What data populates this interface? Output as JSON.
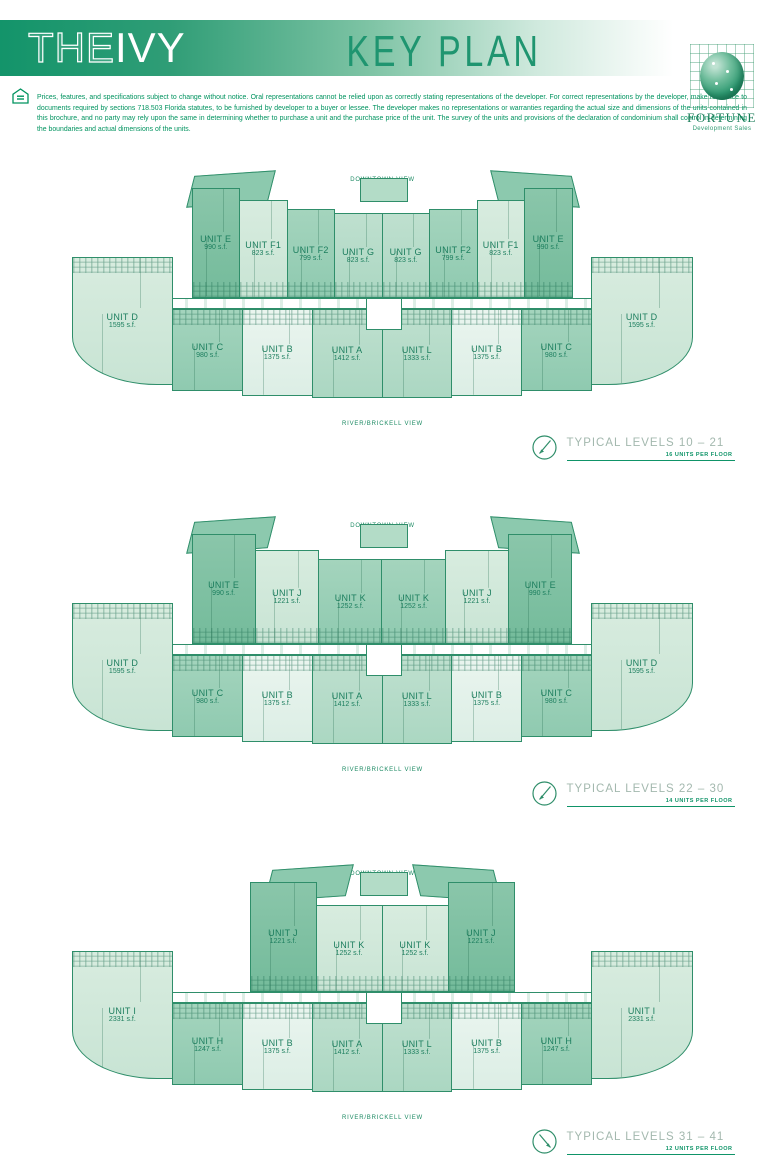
{
  "header": {
    "brand_the": "THE",
    "brand_ivy": "IVY",
    "title": "KEY PLAN",
    "logo_name": "FORTUNE",
    "logo_subtitle": "Development Sales"
  },
  "disclaimer": "Prices, features, and specifications subject to change without notice. Oral representations cannot be relied upon as correctly stating representations of the developer. For correct representations by the developer, make reference to documents required by sections 718.503 Florida statutes, to be furnished by developer to a buyer or lessee. The developer makes no representations or warranties regarding the actual size and dimensions of the units contained in this brochure, and no party may rely upon the same in determining whether to purchase a unit and the purchase price of the unit. The survey of the units and provisions of the declaration of condominium shall control in determining the boundaries and actual dimensions of the units.",
  "plans": [
    {
      "top_view_label": "DOWNTOWN VIEW",
      "bottom_view_label": "RIVER/BRICKELL VIEW",
      "caption": "TYPICAL LEVELS 10 – 21",
      "units_per_floor": "16 UNITS PER FLOOR",
      "top_units": [
        {
          "name": "UNIT E",
          "area": "990 s.f."
        },
        {
          "name": "UNIT F1",
          "area": "823 s.f."
        },
        {
          "name": "UNIT F2",
          "area": "799 s.f."
        },
        {
          "name": "UNIT G",
          "area": "823 s.f."
        },
        {
          "name": "UNIT G",
          "area": "823 s.f."
        },
        {
          "name": "UNIT F2",
          "area": "799 s.f."
        },
        {
          "name": "UNIT F1",
          "area": "823 s.f."
        },
        {
          "name": "UNIT E",
          "area": "990 s.f."
        }
      ],
      "bottom_units": [
        {
          "name": "UNIT D",
          "area": "1595 s.f."
        },
        {
          "name": "UNIT C",
          "area": "980 s.f."
        },
        {
          "name": "UNIT B",
          "area": "1375 s.f."
        },
        {
          "name": "UNIT A",
          "area": "1412 s.f."
        },
        {
          "name": "UNIT L",
          "area": "1333 s.f."
        },
        {
          "name": "UNIT B",
          "area": "1375 s.f."
        },
        {
          "name": "UNIT C",
          "area": "980 s.f."
        },
        {
          "name": "UNIT D",
          "area": "1595 s.f."
        }
      ]
    },
    {
      "top_view_label": "DOWNTOWN VIEW",
      "bottom_view_label": "RIVER/BRICKELL VIEW",
      "caption": "TYPICAL LEVELS 22 – 30",
      "units_per_floor": "14 UNITS PER FLOOR",
      "top_units": [
        {
          "name": "UNIT E",
          "area": "990 s.f."
        },
        {
          "name": "UNIT J",
          "area": "1221 s.f."
        },
        {
          "name": "UNIT K",
          "area": "1252 s.f."
        },
        {
          "name": "UNIT K",
          "area": "1252 s.f."
        },
        {
          "name": "UNIT J",
          "area": "1221 s.f."
        },
        {
          "name": "UNIT E",
          "area": "990 s.f."
        }
      ],
      "bottom_units": [
        {
          "name": "UNIT D",
          "area": "1595 s.f."
        },
        {
          "name": "UNIT C",
          "area": "980 s.f."
        },
        {
          "name": "UNIT B",
          "area": "1375 s.f."
        },
        {
          "name": "UNIT A",
          "area": "1412 s.f."
        },
        {
          "name": "UNIT L",
          "area": "1333 s.f."
        },
        {
          "name": "UNIT B",
          "area": "1375 s.f."
        },
        {
          "name": "UNIT C",
          "area": "980 s.f."
        },
        {
          "name": "UNIT D",
          "area": "1595 s.f."
        }
      ]
    },
    {
      "top_view_label": "DOWNTOWN VIEW",
      "bottom_view_label": "RIVER/BRICKELL VIEW",
      "caption": "TYPICAL LEVELS 31 – 41",
      "units_per_floor": "12 UNITS PER FLOOR",
      "top_units": [
        {
          "name": "UNIT J",
          "area": "1221 s.f."
        },
        {
          "name": "UNIT K",
          "area": "1252 s.f."
        },
        {
          "name": "UNIT K",
          "area": "1252 s.f."
        },
        {
          "name": "UNIT J",
          "area": "1221 s.f."
        }
      ],
      "bottom_units": [
        {
          "name": "UNIT I",
          "area": "2331 s.f."
        },
        {
          "name": "UNIT H",
          "area": "1247 s.f."
        },
        {
          "name": "UNIT B",
          "area": "1375 s.f."
        },
        {
          "name": "UNIT A",
          "area": "1412 s.f."
        },
        {
          "name": "UNIT L",
          "area": "1333 s.f."
        },
        {
          "name": "UNIT B",
          "area": "1375 s.f."
        },
        {
          "name": "UNIT H",
          "area": "1247 s.f."
        },
        {
          "name": "UNIT I",
          "area": "2331 s.f."
        }
      ]
    }
  ],
  "colors": {
    "accent_green": "#0f9468",
    "banner_green": "#13946a",
    "outline_green": "#2f8e6a",
    "caption_gray": "#a3b8ae"
  }
}
